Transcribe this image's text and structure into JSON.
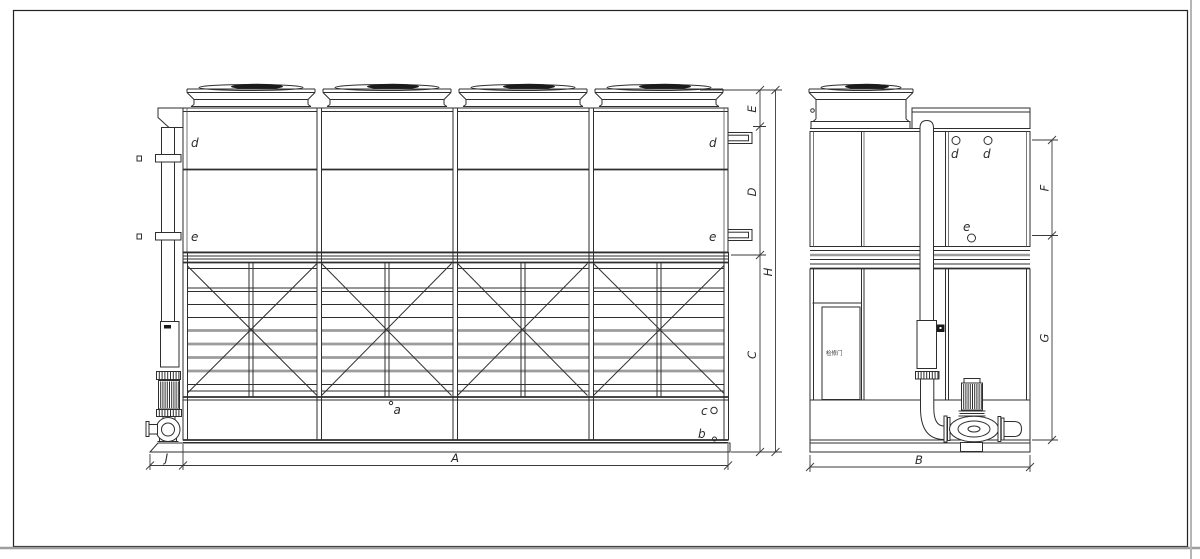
{
  "colors": {
    "line": "#2e2e2e",
    "gray": "#9c9c9c",
    "dark": "#1b1b1b",
    "bg": "#ffffff",
    "frame": "#a9a9a9"
  },
  "front_view": {
    "connection_labels": {
      "d_left": "d",
      "e_left": "e",
      "d_right": "d",
      "e_right": "e"
    },
    "part_labels": {
      "a": "a",
      "b": "b",
      "c": "c"
    },
    "dimensions": {
      "A": "A",
      "J": "J",
      "C": "C",
      "D": "D",
      "E": "E",
      "H": "H"
    }
  },
  "side_view": {
    "connection_labels": {
      "d1": "d",
      "d2": "d",
      "e": "e"
    },
    "door_label": "检修门",
    "dimensions": {
      "B": "B",
      "F": "F",
      "G": "G"
    }
  }
}
